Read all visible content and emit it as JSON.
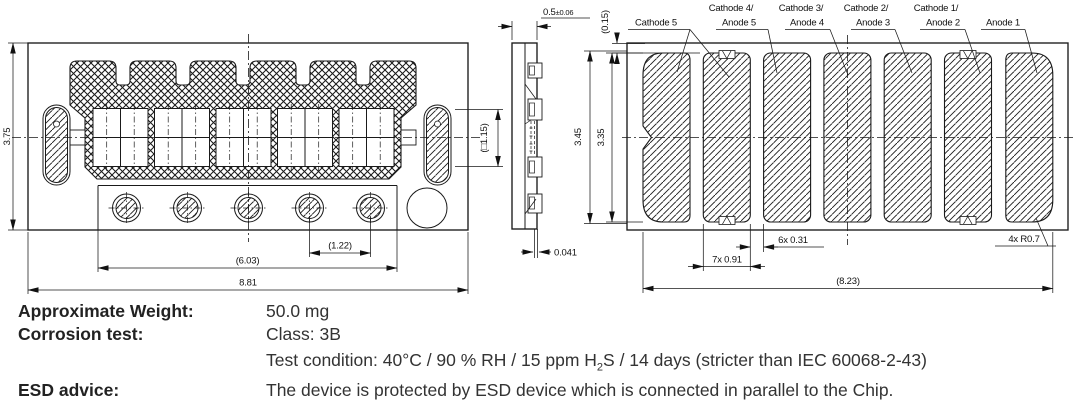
{
  "drawing": {
    "front_view": {
      "dim_height": "3.75",
      "dim_hole_pitch": "(1.22)",
      "dim_hole_span": "(6.03)",
      "dim_width": "8.81",
      "dim_window": "(□1.15)"
    },
    "side_view": {
      "dim_thickness": "0.5",
      "dim_thickness_tol": "±0.06",
      "dim_standoff": "0.041"
    },
    "bottom_view": {
      "dim_top_gap": "(0.15)",
      "dim_outer_height": "3.45",
      "dim_pad_height": "3.35",
      "dim_pad_gap": "6x 0.31",
      "dim_pad_width": "7x 0.91",
      "dim_pad_span": "(8.23)",
      "dim_corner_radius": "4x R0.7",
      "pins": [
        [
          "Cathode 5"
        ],
        [
          "Cathode 4/",
          "Anode 5"
        ],
        [
          "Cathode 3/",
          "Anode 4"
        ],
        [
          "Cathode 2/",
          "Anode 3"
        ],
        [
          "Cathode 1/",
          "Anode 2"
        ],
        [
          "Anode 1"
        ]
      ]
    }
  },
  "specs": {
    "weight_label": "Approximate Weight:",
    "weight_value": "50.0 mg",
    "corrosion_label": "Corrosion test:",
    "corrosion_class": "Class: 3B",
    "test_condition_pre": "Test condition: 40°C / 90 % RH / 15 ppm H",
    "test_condition_sub": "2",
    "test_condition_post": "S / 14 days (stricter than IEC  60068-2-43)",
    "esd_label": "ESD advice:",
    "esd_value": "The device is protected by ESD device which is connected in parallel to the Chip."
  }
}
